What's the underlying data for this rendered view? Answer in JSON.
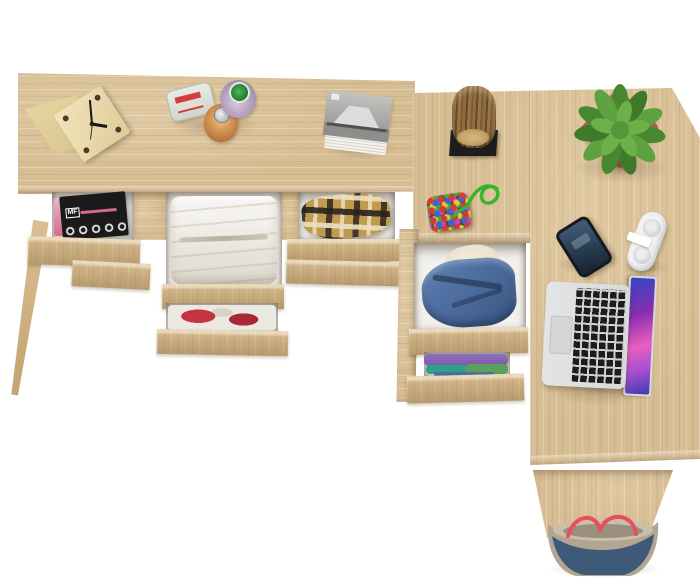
{
  "scene": {
    "type": "product-photo",
    "description": "Top-down 3D render of an L-shaped light-oak desk with open drawers of folded clothes, a corner drawer cabinet, and decor items, on a plain white background",
    "background_color": "#ffffff"
  },
  "objects": {
    "desk": {
      "finish": "sonoma oak",
      "parts": [
        "left dressing table with three open drawer bays",
        "corner cabinet with two open clothes drawers",
        "right desk return with side panel"
      ]
    },
    "clock": {
      "desc": "wooden cube clock with black hands"
    },
    "perfume_bottles": {
      "desc": "three perfume bottles: clear with red stripe, amber with silver cap, round with green cap"
    },
    "books": {
      "desc": "stack of grey and white books"
    },
    "magazines": {
      "label": "MF",
      "desc": "black music magazines in open left drawer"
    },
    "white_clothes": {
      "desc": "folded white garment in open centre drawer"
    },
    "red_clothes": {
      "desc": "red and white clothes in lower centre drawer"
    },
    "plaid_shirt": {
      "desc": "brown-black checked shirt in open right drawer"
    },
    "log_ornament": {
      "desc": "wooden log decor piece on black stand"
    },
    "keychain": {
      "desc": "multicoloured bead pouch with green cord"
    },
    "denim_jacket": {
      "desc": "denim jacket with cream lining in cabinet drawer"
    },
    "folded_shirts": {
      "desc": "purple, teal, green and blue folded shirts in lower cabinet drawer"
    },
    "plant": {
      "desc": "green leafy plant in square terracotta pot"
    },
    "phone": {
      "desc": "black smartphone with dark blue lock screen"
    },
    "white_device": {
      "desc": "white hinged gadget with two round pads"
    },
    "laptop": {
      "desc": "silver laptop, keyboard left, colourful wallpaper screen right"
    },
    "bag": {
      "desc": "denim tote bag with taupe base and red rope handles"
    }
  },
  "colors": {
    "wood": "#d7bd93",
    "wood_front": "#cfb285",
    "interior_white": "#f2f1ee",
    "magazine_black": "#1a1a1a",
    "magazine_pink": "#d66a8e",
    "cloth_white": "#f5f3ef",
    "plaid_base": "#c09a4e",
    "red_cloth": "#c53441",
    "denim": "#4d6da0",
    "denim_dark": "#3c5884",
    "lining": "#eae3cf",
    "purple": "#7a5ba8",
    "teal": "#2e9f8b",
    "green_cloth": "#58a05c",
    "blue_cloth": "#4a6e9e",
    "pot": "#b3584a",
    "plant_green": "#4f9038",
    "plant_light": "#6db04a",
    "cord_green": "#35b52c",
    "phone_body": "#17191d",
    "phone_screen_a": "#44607c",
    "phone_screen_b": "#16222e",
    "device_white": "#f0f1f3",
    "device_grey": "#d5d7d9",
    "laptop_silver": "#d7d9db",
    "key_black": "#1d1d1f",
    "screen_purple": "#8a2db0",
    "screen_pink": "#e95fc0",
    "screen_blue": "#3346c4",
    "bag_denim": "#3e5a78",
    "bag_taupe": "#b2a692",
    "bag_rope": "#e84f5e",
    "log_bark": "#8f6c3e",
    "log_face": "#c5a369",
    "stand_black": "#1d1d1d",
    "clock_wood": "#ecdcb3",
    "clock_side": "#d9c48f"
  }
}
